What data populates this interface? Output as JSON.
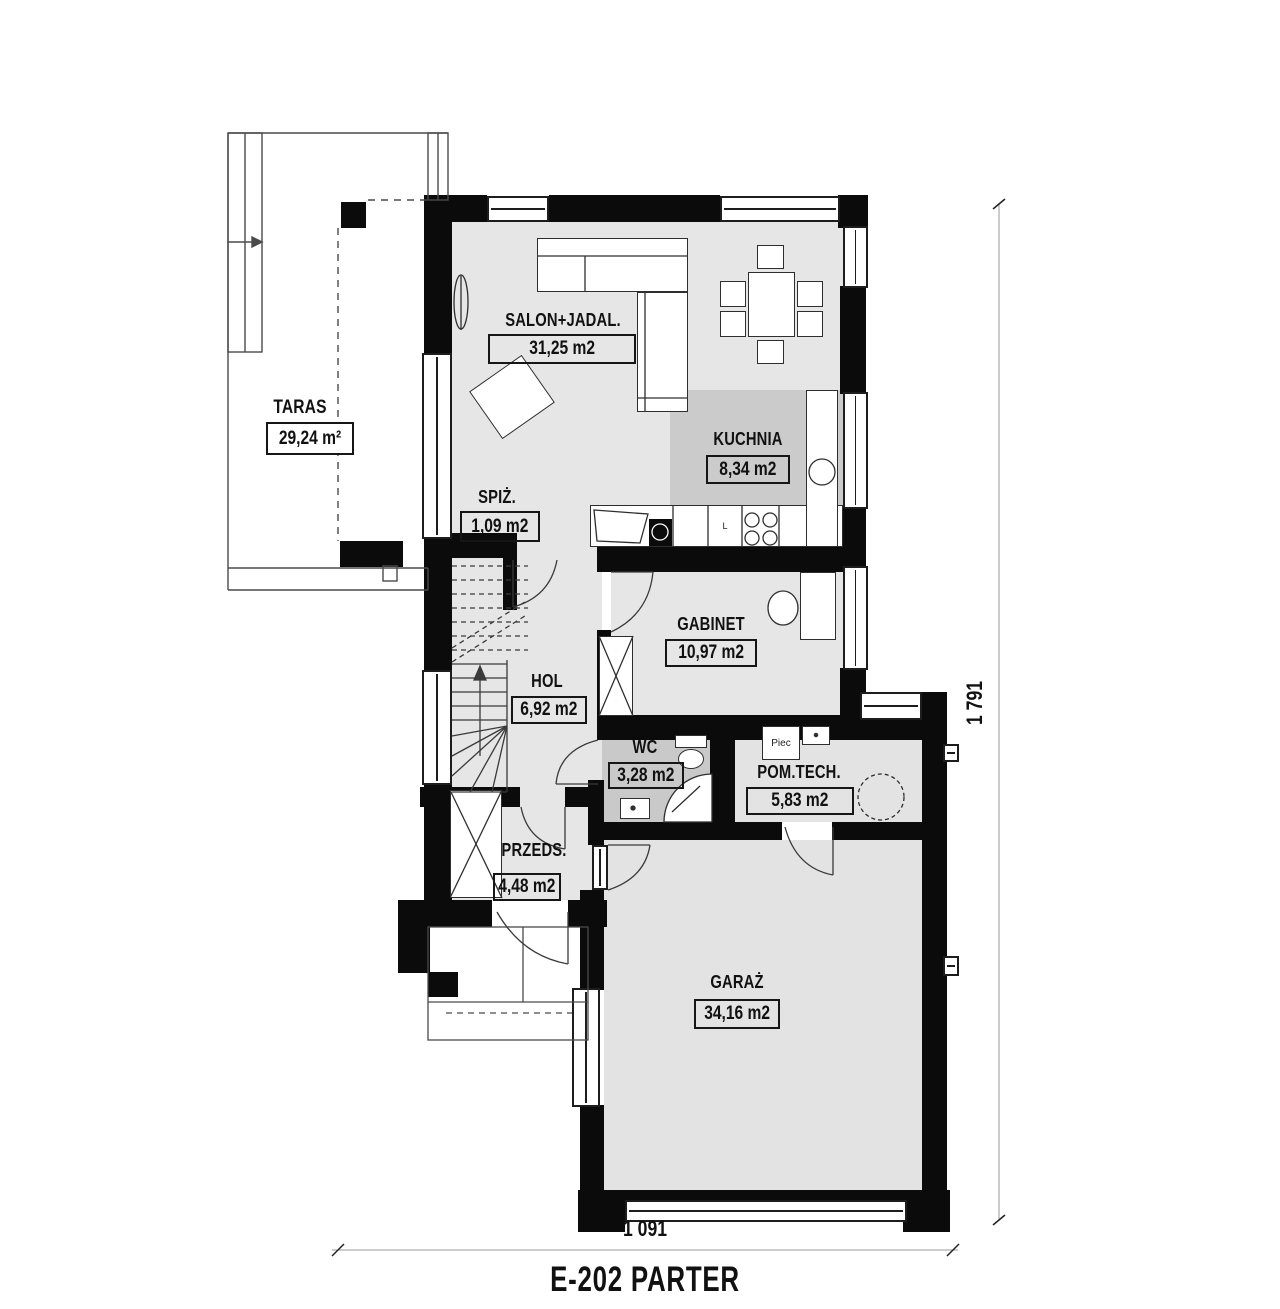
{
  "title": "E-202 PARTER",
  "dimensions": {
    "width_label": "1 091",
    "height_label": "1 791"
  },
  "rooms": {
    "taras": {
      "name": "TARAS",
      "area": "29,24 m²"
    },
    "salon": {
      "name": "SALON+JADAL.",
      "area": "31,25 m2"
    },
    "kuchnia": {
      "name": "KUCHNIA",
      "area": "8,34 m2"
    },
    "spiz": {
      "name": "SPIŻ.",
      "area": "1,09 m2"
    },
    "gabinet": {
      "name": "GABINET",
      "area": "10,97 m2"
    },
    "hol": {
      "name": "HOL",
      "area": "6,92 m2"
    },
    "wc": {
      "name": "WC",
      "area": "3,28 m2"
    },
    "pomtech": {
      "name": "POM.TECH.",
      "area": "5,83 m2"
    },
    "przeds": {
      "name": "PRZEDS.",
      "area": "4,48 m2"
    },
    "garaz": {
      "name": "GARAŻ",
      "area": "34,16 m2"
    }
  },
  "annotations": {
    "furnace": "Piec",
    "fridge": "L"
  },
  "colors": {
    "wall": "#0b0b0b",
    "floor": "#e6e6e6",
    "floor_dark": "#cbcbcb",
    "line": "#3a3a3a"
  }
}
